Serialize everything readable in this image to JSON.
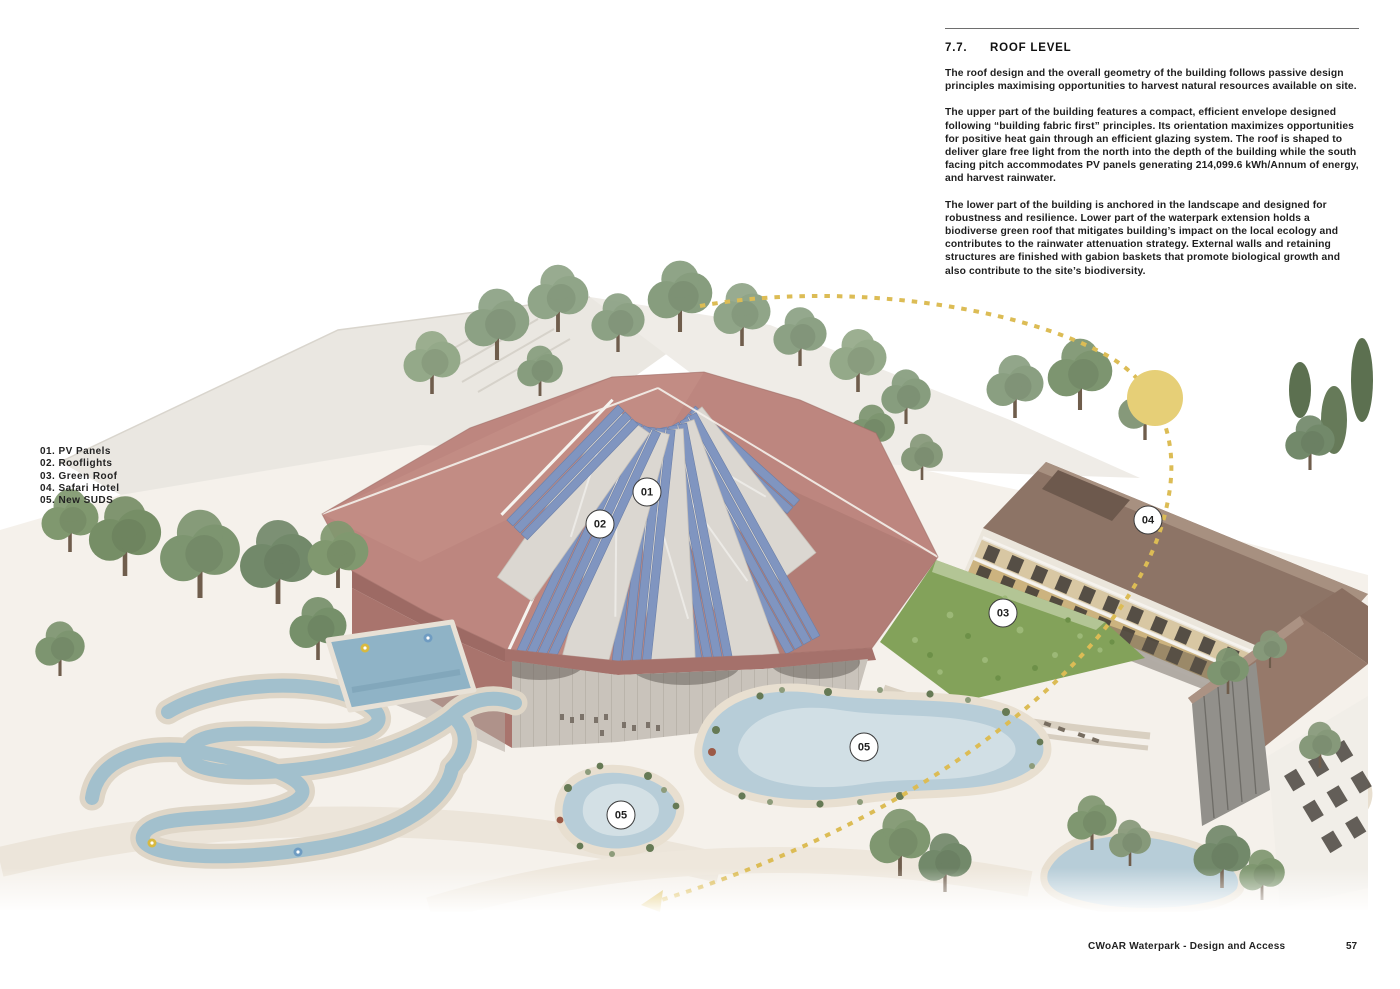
{
  "document": {
    "section_number": "7.7.",
    "section_title": "ROOF LEVEL",
    "paragraphs": [
      "The roof design and the overall geometry of the building follows passive design principles maximising opportunities to harvest natural resources available on site.",
      "The upper part of the building features a compact, efficient envelope designed following “building fabric first” principles. Its orientation maximizes opportunities for positive heat gain through an efficient glazing system. The roof is shaped to deliver glare free light from the north into the depth of the building while the south facing pitch accommodates PV panels generating 214,099.6 kWh/Annum of energy, and harvest rainwater.",
      "The lower part of the building is anchored in the landscape and designed for robustness and resilience. Lower part of the waterpark extension holds a biodiverse green roof that mitigates building’s impact on the local ecology and contributes to the rainwater attenuation strategy. External walls and retaining structures are finished with gabion baskets that promote biological growth and also contribute to the site’s biodiversity."
    ],
    "footer": {
      "title": "CWoAR Waterpark - Design and Access",
      "page_number": "57"
    }
  },
  "legend": {
    "items": [
      {
        "label": "01. PV Panels"
      },
      {
        "label": "02. Rooflights"
      },
      {
        "label": "03. Green Roof"
      },
      {
        "label": "04. Safari Hotel"
      },
      {
        "label": "05. New SUDS"
      }
    ]
  },
  "figure": {
    "description": "Aerial render of the waterpark roof level with Safari Hotel, green roof and SUDS ponds",
    "callouts": [
      {
        "id": "01"
      },
      {
        "id": "02"
      },
      {
        "id": "03"
      },
      {
        "id": "04"
      },
      {
        "id": "05"
      },
      {
        "id": "05"
      }
    ],
    "colors": {
      "roof": "#bd867f",
      "pv_panel": "#8095c0",
      "rooflight": "#dbd7d1",
      "green_roof": "#83a25a",
      "water": "#a2c0cd",
      "suds_pond": "#b7cdd8",
      "hotel_roof": "#8d7466",
      "sun": "#e6cf77",
      "sun_path": "#dcbc55"
    }
  }
}
